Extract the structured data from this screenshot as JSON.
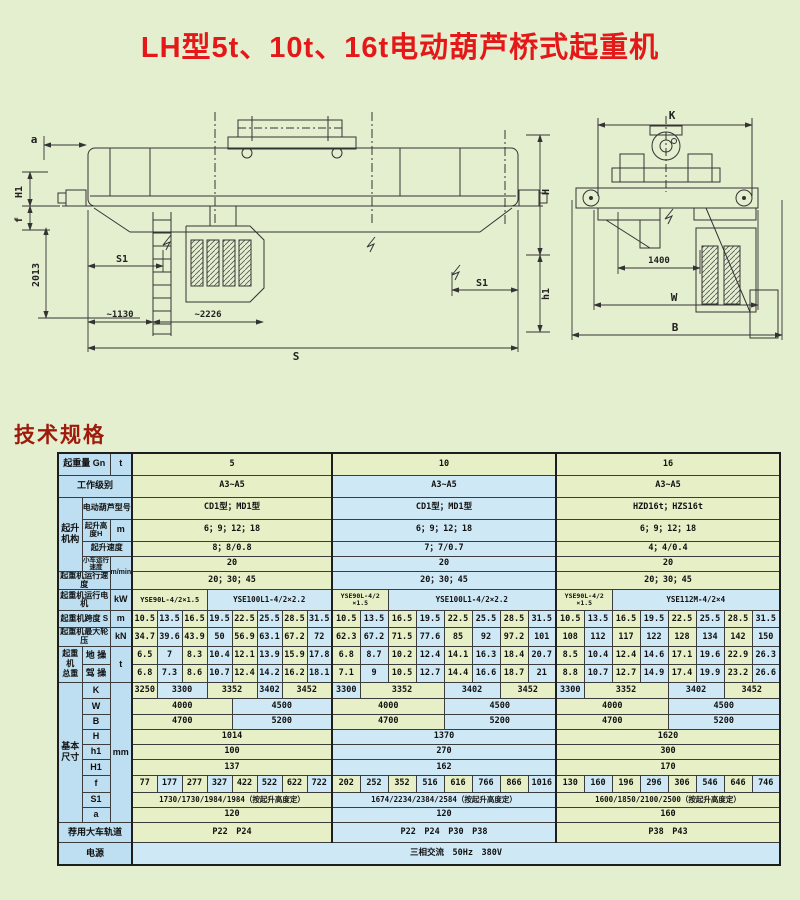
{
  "page": {
    "title": "LH型5t、10t、16t电动葫芦桥式起重机",
    "title_color": "#e41818",
    "section_heading": "技术规格",
    "section_heading_color": "#9e1a0a",
    "background": "#e4efd0"
  },
  "drawings": {
    "left_view": {
      "a": "a",
      "H1": "H1",
      "f": "f",
      "dim2013": "2013",
      "S1_left": "S1",
      "dim1130": "~1130",
      "dim2226": "~2226",
      "S": "S",
      "H": "H",
      "h1": "h1",
      "S1_right": "S1"
    },
    "right_view": {
      "K": "K",
      "dim1400": "1400",
      "W": "W",
      "B": "B"
    }
  },
  "table": {
    "palette": {
      "green": "#e7efc7",
      "blue": "#cfe8f5",
      "header": "#bedff1",
      "border": "#3c3c3c"
    },
    "rows": [
      {
        "h": 22,
        "cells": [
          {
            "t": "起重量 Gn",
            "cs": 2,
            "k": "label"
          },
          {
            "t": "t",
            "k": "unit"
          },
          {
            "t": "5",
            "cs": 8,
            "c": "g"
          },
          {
            "t": "10",
            "cs": 8,
            "c": "g"
          },
          {
            "t": "16",
            "cs": 8,
            "c": "g"
          }
        ]
      },
      {
        "h": 22,
        "cells": [
          {
            "t": "工作级别",
            "cs": 3,
            "k": "label"
          },
          {
            "t": "A3~A5",
            "cs": 8
          },
          {
            "t": "A3~A5",
            "cs": 8
          },
          {
            "t": "A3~A5",
            "cs": 8
          }
        ]
      },
      {
        "h": 22,
        "cells": [
          {
            "t": "起升\n机构",
            "rs": 4,
            "k": "group"
          },
          {
            "t": "电动葫芦型号",
            "cs": 2,
            "k": "label",
            "f": 8
          },
          {
            "t": "CD1型；MD1型",
            "cs": 8,
            "f": 8.5
          },
          {
            "t": "CD1型；MD1型",
            "cs": 8,
            "f": 8.5
          },
          {
            "t": "HZD16t；HZS16t",
            "cs": 8,
            "f": 8.5
          }
        ]
      },
      {
        "h": 22,
        "cells": [
          {
            "t": "起升高度H",
            "k": "label",
            "f": 7.5
          },
          {
            "t": "m",
            "k": "unit"
          },
          {
            "t": "6；9；12；18",
            "cs": 8
          },
          {
            "t": "6；9；12；18",
            "cs": 8
          },
          {
            "t": "6；9；12；18",
            "cs": 8
          }
        ]
      },
      {
        "h": 15,
        "cells": [
          {
            "t": "起升速度",
            "cs": 2,
            "k": "label",
            "f": 8
          },
          {
            "t": "8；8/0.8",
            "cs": 8
          },
          {
            "t": "7；7/0.7",
            "cs": 8
          },
          {
            "t": "4；4/0.4",
            "cs": 8
          }
        ]
      },
      {
        "h": 12,
        "cells": [
          {
            "t": "小车运行速度",
            "k": "label",
            "f": 6.5
          },
          {
            "t": "m/min",
            "rs": 2,
            "k": "unit",
            "f": 7
          },
          {
            "t": "20",
            "cs": 8
          },
          {
            "t": "20",
            "cs": 8
          },
          {
            "t": "20",
            "cs": 8
          }
        ]
      },
      {
        "h": 16,
        "cells": [
          {
            "t": "起重机运行速度",
            "cs": 2,
            "k": "label",
            "f": 8
          },
          {
            "t": "20；30；45",
            "cs": 8
          },
          {
            "t": "20；30；45",
            "cs": 8
          },
          {
            "t": "20；30；45",
            "cs": 8
          }
        ]
      },
      {
        "h": 21,
        "cells": [
          {
            "t": "起重机运行电机",
            "cs": 2,
            "k": "label",
            "f": 8
          },
          {
            "t": "kW",
            "k": "unit"
          },
          {
            "t": "YSE90L-4/2×1.5",
            "cs": 3,
            "f": 7
          },
          {
            "t": "YSE100L1-4/2×2.2",
            "cs": 5,
            "f": 7.5
          },
          {
            "t": "YSE90L-4/2\n×1.5",
            "cs": 2,
            "f": 6.5
          },
          {
            "t": "YSE100L1-4/2×2.2",
            "cs": 6,
            "f": 7.5
          },
          {
            "t": "YSE90L-4/2\n×1.5",
            "cs": 2,
            "f": 6.5
          },
          {
            "t": "YSE112M-4/2×4",
            "cs": 6,
            "f": 7.5
          }
        ]
      },
      {
        "h": 17,
        "cells": [
          {
            "t": "起重机跨度 S",
            "cs": 2,
            "k": "label",
            "f": 8
          },
          {
            "t": "m",
            "k": "unit"
          },
          "10.5",
          "13.5",
          "16.5",
          "19.5",
          "22.5",
          "25.5",
          "28.5",
          "31.5",
          "10.5",
          "13.5",
          "16.5",
          "19.5",
          "22.5",
          "25.5",
          "28.5",
          "31.5",
          "10.5",
          "13.5",
          "16.5",
          "19.5",
          "22.5",
          "25.5",
          "28.5",
          "31.5"
        ]
      },
      {
        "h": 17,
        "cells": [
          {
            "t": "起重机最大轮压",
            "cs": 2,
            "k": "label",
            "f": 8
          },
          {
            "t": "kN",
            "k": "unit"
          },
          "34.7",
          "39.6",
          "43.9",
          "50",
          "56.9",
          "63.1",
          "67.2",
          "72",
          "62.3",
          "67.2",
          "71.5",
          "77.6",
          "85",
          "92",
          "97.2",
          "101",
          "108",
          "112",
          "117",
          "122",
          "128",
          "134",
          "142",
          "150"
        ]
      },
      {
        "h": 18,
        "cells": [
          {
            "t": "起重\n机\n总重",
            "rs": 2,
            "k": "group",
            "f": 8
          },
          {
            "t": "地 操",
            "k": "label"
          },
          {
            "t": "t",
            "rs": 2,
            "k": "unit"
          },
          "6.5",
          "7",
          "8.3",
          "10.4",
          "12.1",
          "13.9",
          "15.9",
          "17.8",
          "6.8",
          "8.7",
          "10.2",
          "12.4",
          "14.1",
          "16.3",
          "18.4",
          "20.7",
          "8.5",
          "10.4",
          "12.4",
          "14.6",
          "17.1",
          "19.6",
          "22.9",
          "26.3"
        ]
      },
      {
        "h": 18,
        "cells": [
          {
            "t": "驾 操",
            "k": "label"
          },
          "6.8",
          "7.3",
          "8.6",
          "10.7",
          "12.4",
          "14.2",
          "16.2",
          "18.1",
          "7.1",
          "9",
          "10.5",
          "12.7",
          "14.4",
          "16.6",
          "18.7",
          "21",
          "8.8",
          "10.7",
          "12.7",
          "14.9",
          "17.4",
          "19.9",
          "23.2",
          "26.6"
        ]
      },
      {
        "h": 16,
        "cells": [
          {
            "t": "基本\n尺寸",
            "rs": 9,
            "k": "group"
          },
          {
            "t": "K",
            "k": "label"
          },
          {
            "t": "mm",
            "rs": 9,
            "k": "unit"
          },
          {
            "t": "3250"
          },
          {
            "t": "3300",
            "cs": 2
          },
          {
            "t": "3352",
            "cs": 2
          },
          {
            "t": "3402"
          },
          {
            "t": "3452",
            "cs": 2
          },
          {
            "t": "3300"
          },
          {
            "t": "3352",
            "cs": 3
          },
          {
            "t": "3402",
            "cs": 2
          },
          {
            "t": "3452",
            "cs": 2
          },
          {
            "t": "3300"
          },
          {
            "t": "3352",
            "cs": 3
          },
          {
            "t": "3402",
            "cs": 2
          },
          {
            "t": "3452",
            "cs": 2
          }
        ]
      },
      {
        "h": 16,
        "cells": [
          {
            "t": "W",
            "k": "label"
          },
          {
            "t": "4000",
            "cs": 4
          },
          {
            "t": "4500",
            "cs": 4
          },
          {
            "t": "4000",
            "cs": 4
          },
          {
            "t": "4500",
            "cs": 4
          },
          {
            "t": "4000",
            "cs": 4
          },
          {
            "t": "4500",
            "cs": 4
          }
        ]
      },
      {
        "h": 15,
        "cells": [
          {
            "t": "B",
            "k": "label"
          },
          {
            "t": "4700",
            "cs": 4
          },
          {
            "t": "5200",
            "cs": 4
          },
          {
            "t": "4700",
            "cs": 4
          },
          {
            "t": "5200",
            "cs": 4
          },
          {
            "t": "4700",
            "cs": 4
          },
          {
            "t": "5200",
            "cs": 4
          }
        ]
      },
      {
        "h": 15,
        "cells": [
          {
            "t": "H",
            "k": "label"
          },
          {
            "t": "1014",
            "cs": 8
          },
          {
            "t": "1370",
            "cs": 8
          },
          {
            "t": "1620",
            "cs": 8
          }
        ]
      },
      {
        "h": 15,
        "cells": [
          {
            "t": "h1",
            "k": "label"
          },
          {
            "t": "100",
            "cs": 8
          },
          {
            "t": "270",
            "cs": 8
          },
          {
            "t": "300",
            "cs": 8
          }
        ]
      },
      {
        "h": 16,
        "cells": [
          {
            "t": "H1",
            "k": "label"
          },
          {
            "t": "137",
            "cs": 8
          },
          {
            "t": "162",
            "cs": 8
          },
          {
            "t": "170",
            "cs": 8
          }
        ]
      },
      {
        "h": 17,
        "cells": [
          {
            "t": "f",
            "k": "label"
          },
          "77",
          "177",
          "277",
          "327",
          "422",
          "522",
          "622",
          "722",
          "202",
          "252",
          "352",
          "516",
          "616",
          "766",
          "866",
          "1016",
          "130",
          "160",
          "196",
          "296",
          "306",
          "546",
          "646",
          "746"
        ]
      },
      {
        "h": 15,
        "cells": [
          {
            "t": "S1",
            "k": "label"
          },
          {
            "t": "1730/1730/1984/1984（按起升高度定）",
            "cs": 8,
            "f": 7.5
          },
          {
            "t": "1674/2234/2384/2584（按起升高度定）",
            "cs": 8,
            "f": 7.5
          },
          {
            "t": "1600/1850/2100/2500（按起升高度定）",
            "cs": 8,
            "f": 7.5
          }
        ]
      },
      {
        "h": 15,
        "cells": [
          {
            "t": "a",
            "k": "label"
          },
          {
            "t": "120",
            "cs": 8
          },
          {
            "t": "120",
            "cs": 8
          },
          {
            "t": "160",
            "cs": 8
          }
        ]
      },
      {
        "h": 20,
        "cells": [
          {
            "t": "荐用大车轨道",
            "cs": 3,
            "k": "label"
          },
          {
            "t": "P22　P24",
            "cs": 8
          },
          {
            "t": "P22　P24　P30　P38",
            "cs": 8
          },
          {
            "t": "P38　P43",
            "cs": 8
          }
        ]
      },
      {
        "h": 23,
        "cells": [
          {
            "t": "电源",
            "cs": 3,
            "k": "label"
          },
          {
            "t": "三相交流　50Hz　380V",
            "cs": 24,
            "c": "b"
          }
        ]
      }
    ]
  }
}
